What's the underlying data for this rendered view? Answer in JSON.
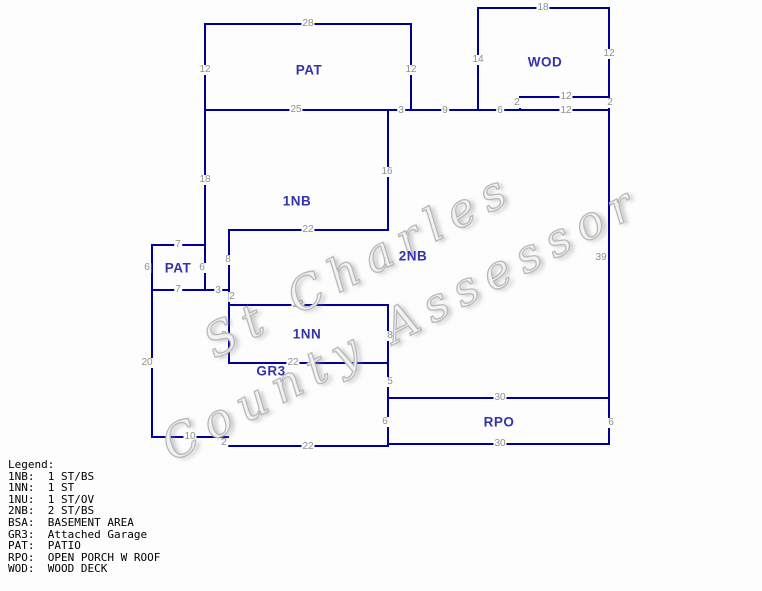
{
  "sketch": {
    "background": "#fdfdfd",
    "line_color": "#000099",
    "area_label_color": "#3333aa",
    "dimension_color": "#8f8f8f",
    "walls": {
      "horizontal": [
        [
          205,
          411,
          24
        ],
        [
          478,
          609,
          8
        ],
        [
          520,
          609,
          97
        ],
        [
          205,
          609,
          110
        ],
        [
          229,
          388,
          230
        ],
        [
          152,
          205,
          245
        ],
        [
          152,
          229,
          290
        ],
        [
          229,
          388,
          305
        ],
        [
          229,
          388,
          363
        ],
        [
          388,
          609,
          398
        ],
        [
          388,
          609,
          444
        ],
        [
          152,
          228,
          437
        ],
        [
          227,
          388,
          446
        ]
      ],
      "vertical": [
        [
          24,
          290,
          205
        ],
        [
          24,
          110,
          411
        ],
        [
          8,
          110,
          478
        ],
        [
          8,
          444,
          609
        ],
        [
          97,
          110,
          520
        ],
        [
          110,
          230,
          388
        ],
        [
          305,
          446,
          388
        ],
        [
          230,
          363,
          229
        ],
        [
          245,
          437,
          152
        ],
        [
          437,
          446,
          227
        ]
      ]
    },
    "dimensions": [
      {
        "t": "28",
        "x": 308,
        "y": 24
      },
      {
        "t": "12",
        "x": 205,
        "y": 70
      },
      {
        "t": "12",
        "x": 411,
        "y": 70
      },
      {
        "t": "25",
        "x": 296,
        "y": 110
      },
      {
        "t": "3",
        "x": 401,
        "y": 111
      },
      {
        "t": "18",
        "x": 543,
        "y": 8
      },
      {
        "t": "14",
        "x": 478,
        "y": 60
      },
      {
        "t": "12",
        "x": 609,
        "y": 54
      },
      {
        "t": "12",
        "x": 566,
        "y": 97
      },
      {
        "t": "2",
        "x": 517,
        "y": 103
      },
      {
        "t": "2",
        "x": 610,
        "y": 103
      },
      {
        "t": "9",
        "x": 445,
        "y": 111
      },
      {
        "t": "6",
        "x": 500,
        "y": 111
      },
      {
        "t": "12",
        "x": 566,
        "y": 111
      },
      {
        "t": "18",
        "x": 205,
        "y": 180
      },
      {
        "t": "16",
        "x": 387,
        "y": 172
      },
      {
        "t": "22",
        "x": 308,
        "y": 230
      },
      {
        "t": "7",
        "x": 178,
        "y": 245
      },
      {
        "t": "6",
        "x": 147,
        "y": 268
      },
      {
        "t": "6",
        "x": 202,
        "y": 268
      },
      {
        "t": "8",
        "x": 228,
        "y": 260
      },
      {
        "t": "7",
        "x": 178,
        "y": 290
      },
      {
        "t": "3",
        "x": 218,
        "y": 291
      },
      {
        "t": "2",
        "x": 232,
        "y": 297
      },
      {
        "t": "22",
        "x": 298,
        "y": 305
      },
      {
        "t": "8",
        "x": 224,
        "y": 336
      },
      {
        "t": "8",
        "x": 390,
        "y": 336
      },
      {
        "t": "22",
        "x": 293,
        "y": 363
      },
      {
        "t": "39",
        "x": 601,
        "y": 258
      },
      {
        "t": "5",
        "x": 390,
        "y": 382
      },
      {
        "t": "30",
        "x": 500,
        "y": 398
      },
      {
        "t": "6",
        "x": 385,
        "y": 422
      },
      {
        "t": "6",
        "x": 611,
        "y": 423
      },
      {
        "t": "30",
        "x": 500,
        "y": 444
      },
      {
        "t": "20",
        "x": 147,
        "y": 363
      },
      {
        "t": "10",
        "x": 190,
        "y": 437
      },
      {
        "t": "2",
        "x": 224,
        "y": 443
      },
      {
        "t": "22",
        "x": 308,
        "y": 447
      }
    ],
    "areas": [
      {
        "t": "PAT",
        "x": 309,
        "y": 70
      },
      {
        "t": "WOD",
        "x": 545,
        "y": 62
      },
      {
        "t": "1NB",
        "x": 297,
        "y": 201
      },
      {
        "t": "2NB",
        "x": 413,
        "y": 256
      },
      {
        "t": "PAT",
        "x": 178,
        "y": 268
      },
      {
        "t": "1NN",
        "x": 307,
        "y": 334
      },
      {
        "t": "GR3",
        "x": 271,
        "y": 371
      },
      {
        "t": "RPO",
        "x": 499,
        "y": 422
      }
    ]
  },
  "watermark": {
    "line1": "St Charles",
    "line2": "County Assessor",
    "color": "#bdbdbd"
  },
  "legend": {
    "title": "Legend:",
    "entries": [
      {
        "code": "1NB",
        "desc": "1 ST/BS"
      },
      {
        "code": "1NN",
        "desc": "1 ST"
      },
      {
        "code": "1NU",
        "desc": "1 ST/OV"
      },
      {
        "code": "2NB",
        "desc": "2 ST/BS"
      },
      {
        "code": "BSA",
        "desc": "BASEMENT AREA"
      },
      {
        "code": "GR3",
        "desc": "Attached Garage"
      },
      {
        "code": "PAT",
        "desc": "PATIO"
      },
      {
        "code": "RPO",
        "desc": "OPEN PORCH W ROOF"
      },
      {
        "code": "WOD",
        "desc": "WOOD DECK"
      }
    ]
  }
}
